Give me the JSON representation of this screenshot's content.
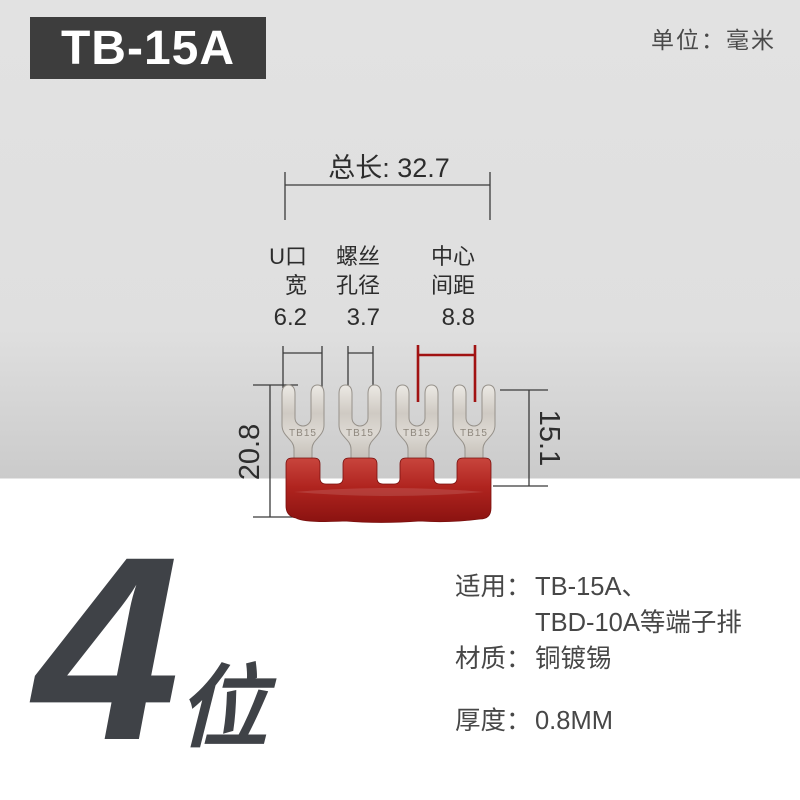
{
  "header": {
    "model": "TB-15A",
    "unit_label": "单位：毫米"
  },
  "diagram": {
    "total_length_label": "总长: 32.7",
    "columns": [
      {
        "line1": "U口",
        "line2": "宽",
        "value": "6.2"
      },
      {
        "line1": "螺丝",
        "line2": "孔径",
        "value": "3.7"
      },
      {
        "line1": "中心",
        "line2": "间距",
        "value": "8.8"
      }
    ],
    "height_left": "20.8",
    "height_right": "15.1",
    "line_color": "#3b3b3b",
    "accent_color": "#a11212"
  },
  "product": {
    "stamp": "TB15",
    "positions": 4,
    "base_color": "#b0241f",
    "terminal_color": "#d3cec7"
  },
  "footer": {
    "count_number": "4",
    "count_unit": "位",
    "specs": [
      {
        "label": "适用：",
        "value": "TB-15A、",
        "value2": "TBD-10A等端子排"
      },
      {
        "label": "材质：",
        "value": "铜镀锡",
        "value2": ""
      },
      {
        "label": "厚度：",
        "value": "0.8MM",
        "value2": ""
      }
    ]
  }
}
